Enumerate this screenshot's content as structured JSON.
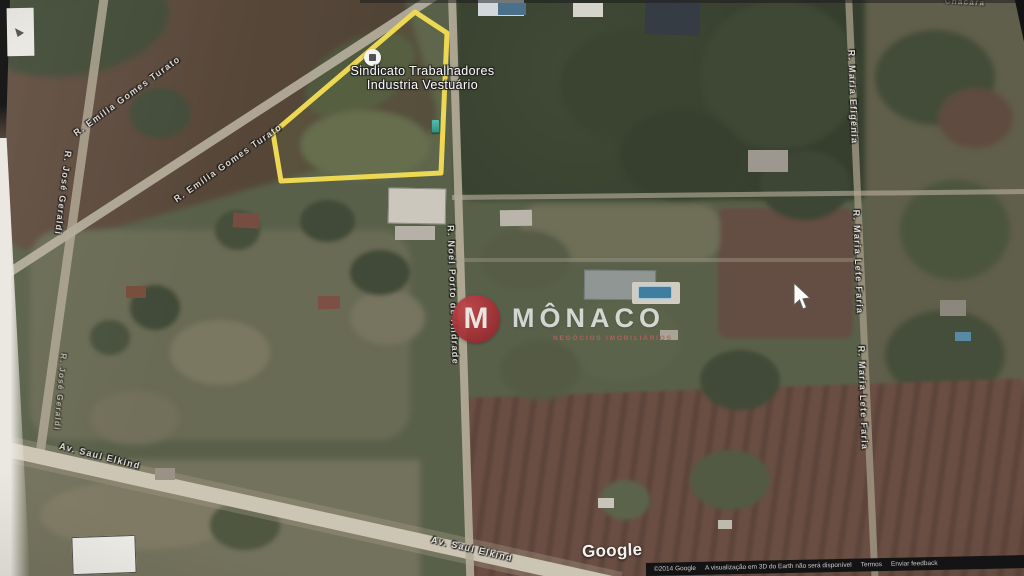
{
  "map": {
    "poi": {
      "line1": "Sindicato Trabalhadores",
      "line2": "Industria Vestuário"
    },
    "streets": [
      {
        "id": "emilia-gomes-turato-upper",
        "text": "R. Emília Gomes Turato"
      },
      {
        "id": "emilia-gomes-turato-lower",
        "text": "R. Emília Gomes Turato"
      },
      {
        "id": "jose-geraldi-upper",
        "text": "R. José Geraldi"
      },
      {
        "id": "jose-geraldi-lower",
        "text": "R. José Geraldi"
      },
      {
        "id": "noel-porto-andrade",
        "text": "R. Noel Porto de Andrade"
      },
      {
        "id": "maria-efigenia",
        "text": "R. Maria Efigênia"
      },
      {
        "id": "maria-lete-faria-upper",
        "text": "R. Maria Lete Faria"
      },
      {
        "id": "maria-lete-faria-lower",
        "text": "R. Maria Lete Faria"
      },
      {
        "id": "saul-elkind-left",
        "text": "Av. Saul Elkind"
      },
      {
        "id": "saul-elkind-center",
        "text": "Av. Saul Elkind"
      },
      {
        "id": "chacara-partial",
        "text": "Chácara"
      }
    ],
    "watermark": {
      "monogram": "M",
      "brand": "MÔNACO",
      "tagline": "NEGÓCIOS IMOBILIÁRIOS"
    },
    "attribution": {
      "logo": "Google",
      "items": [
        "©2014 Google",
        "A visualização em 3D do Earth não será disponível",
        "Termos",
        "Enviar feedback"
      ]
    }
  },
  "colors": {
    "parcel_outline": "#f2d832",
    "brand_red": "#b5262c",
    "pin_teal": "#29b09e",
    "pool_blue": "#2e7ca8"
  }
}
